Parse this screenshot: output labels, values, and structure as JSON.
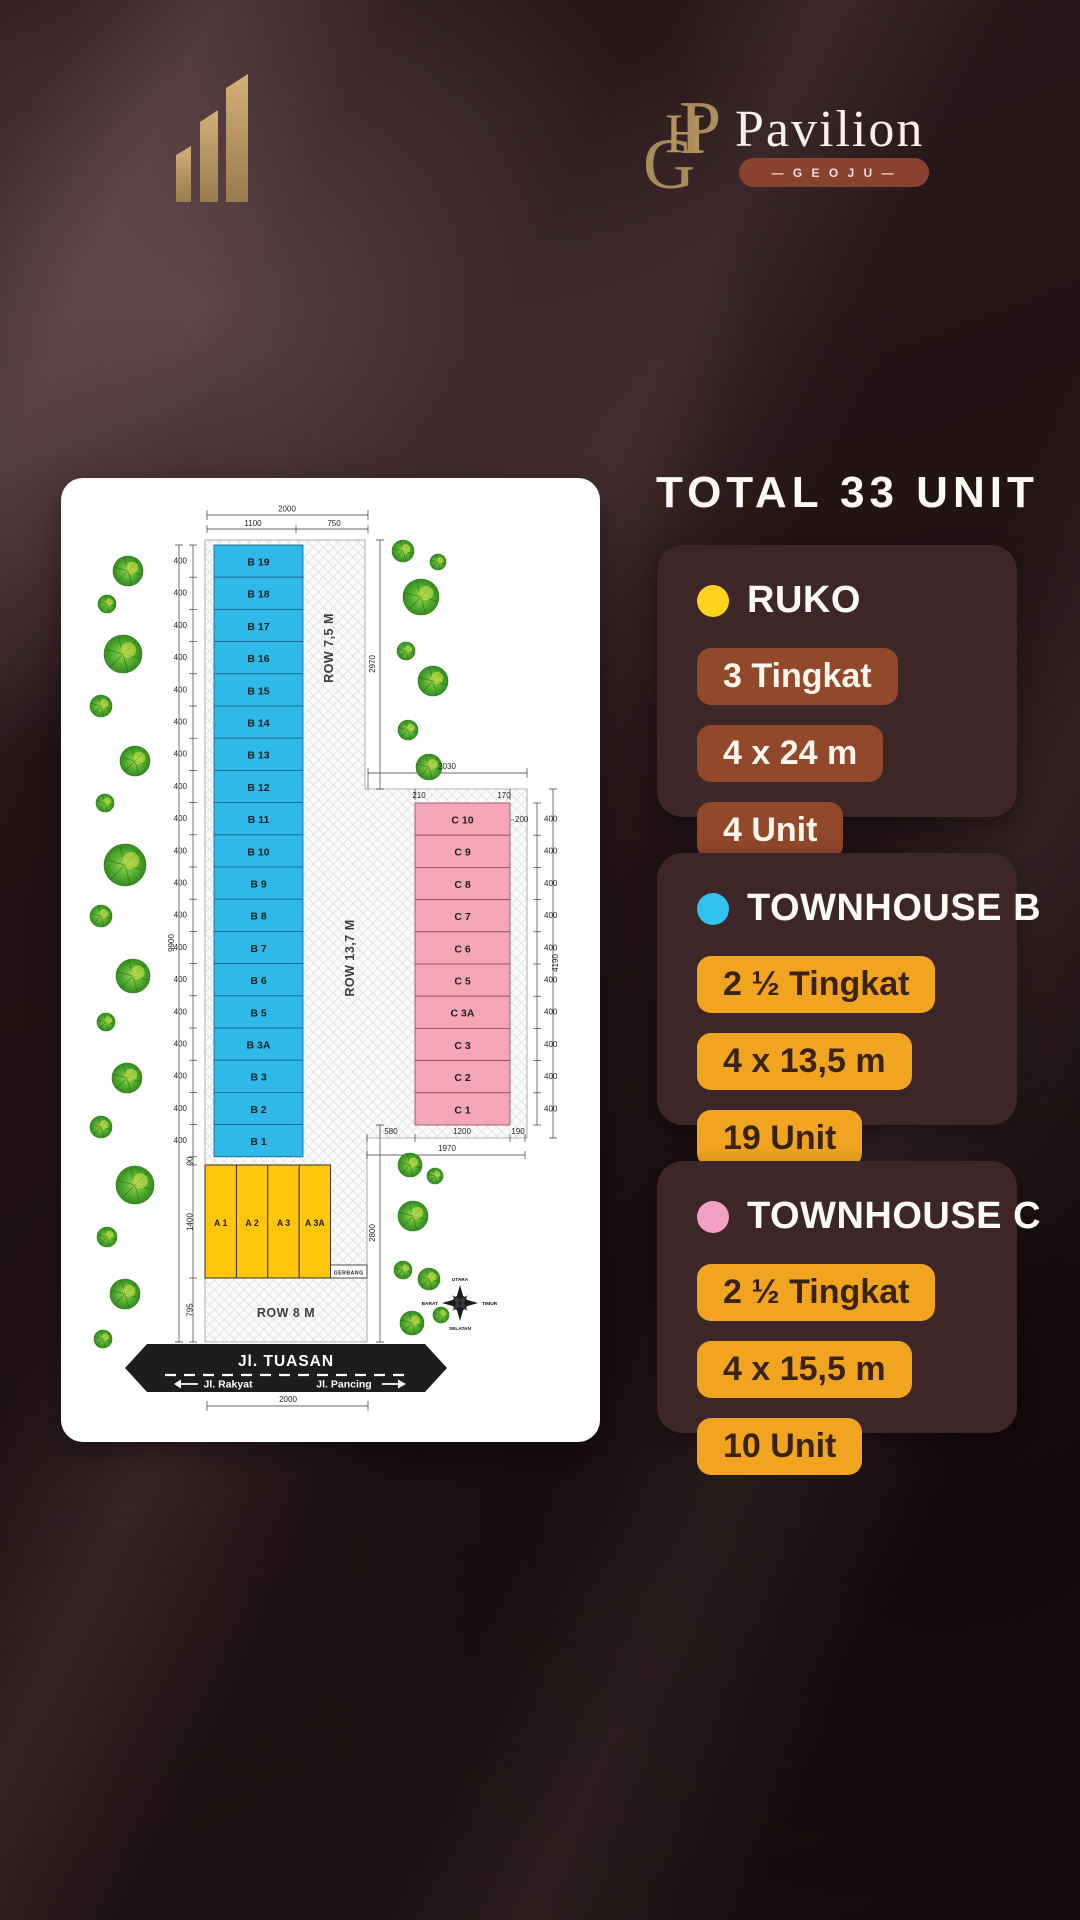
{
  "page": {
    "background": "#2B181B"
  },
  "brand": {
    "monogram_letters": [
      "G",
      "H",
      "P"
    ],
    "name": "Pavilion",
    "badge": "—  G E O J U  —"
  },
  "summary": {
    "title": "TOTAL 33 UNIT",
    "cards": [
      {
        "id": "ruko",
        "dot_color": "#FFD21E",
        "title": "RUKO",
        "pill_bg": "#91482B",
        "pill_fg": "#FFF6EC",
        "pills": [
          "3 Tingkat",
          "4 x 24 m",
          "4 Unit"
        ]
      },
      {
        "id": "townhouse-b",
        "dot_color": "#33C2F0",
        "title": "TOWNHOUSE B",
        "pill_bg": "#F1A41F",
        "pill_fg": "#3A2313",
        "pills": [
          "2 ½ Tingkat",
          "4 x 13,5 m",
          "19 Unit"
        ]
      },
      {
        "id": "townhouse-c",
        "dot_color": "#F49FC4",
        "title": "TOWNHOUSE C",
        "pill_bg": "#F1A41F",
        "pill_fg": "#3A2313",
        "pills": [
          "2 ½ Tingkat",
          "4 x 15,5 m",
          "10 Unit"
        ]
      }
    ]
  },
  "siteplan": {
    "unit_colors": {
      "a": "#FFC60A",
      "b": "#2FB9E9",
      "c": "#F4A6B8"
    },
    "b_units": [
      "B 19",
      "B 18",
      "B 17",
      "B 16",
      "B 15",
      "B 14",
      "B 13",
      "B 12",
      "B 11",
      "B 10",
      "B 9",
      "B 8",
      "B 7",
      "B 6",
      "B 5",
      "B 3A",
      "B 3",
      "B 2",
      "B 1"
    ],
    "c_units": [
      "C 10",
      "C 9",
      "C 8",
      "C 7",
      "C 6",
      "C 5",
      "C 3A",
      "C 3",
      "C 2",
      "C 1"
    ],
    "a_units": [
      "A 1",
      "A 2",
      "A 3",
      "A 3A"
    ],
    "tick_label": "400",
    "dims": {
      "top_total": "2000",
      "top_left": "1100",
      "top_right": "750",
      "left_total": "9900",
      "gap_b_a": "90",
      "a_height": "1400",
      "row8_height": "795",
      "right_top": "2970",
      "right_bottom": "2800",
      "c_top_total": "2030",
      "c_sub_left": "210",
      "c_sub_right": "170",
      "c_right_small": "200",
      "c_height_total": "4190",
      "bottom_left": "580",
      "bottom_mid": "1200",
      "bottom_right": "190",
      "bottom_total": "1970",
      "road_total": "2000"
    },
    "rows": {
      "row_7_5": "ROW 7,5 M",
      "row_13_7": "ROW 13,7 M",
      "row_8": "ROW 8 M"
    },
    "gate": "GERBANG",
    "road": {
      "name": "Jl. TUASAN",
      "left": "Jl. Rakyat",
      "right": "Jl. Pancing"
    },
    "compass": {
      "north": "UTARA",
      "east": "TIMUR",
      "south": "SELATAN",
      "west": "BARAT"
    }
  }
}
